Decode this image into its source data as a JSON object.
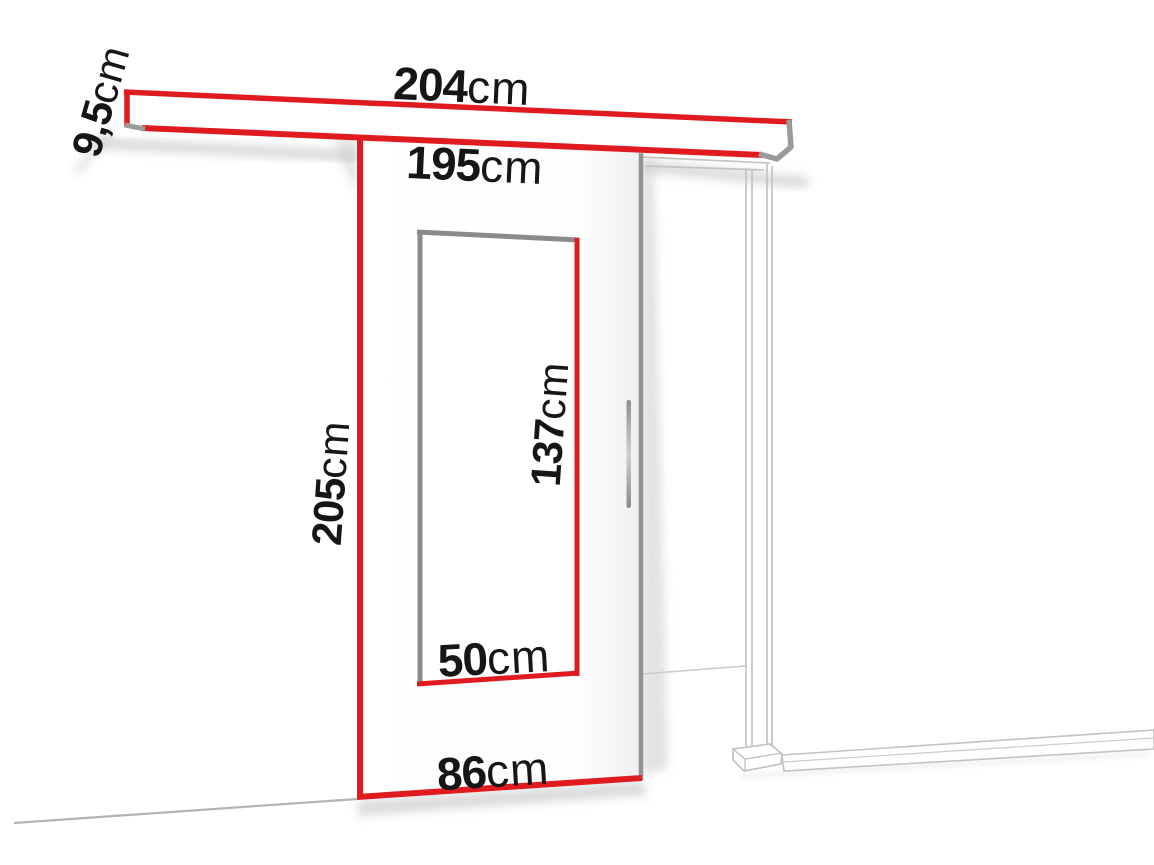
{
  "colors": {
    "accent": "#e01b20",
    "edge_gray": "#8f8f8f",
    "frame_gray": "#c3c3c3",
    "text": "#161616"
  },
  "diagram": {
    "type": "sliding-door-dimension-drawing"
  },
  "labels": {
    "track_length": {
      "value": "204",
      "unit": "cm"
    },
    "track_height": {
      "value": "9,5",
      "unit": "cm"
    },
    "opening_width": {
      "value": "195",
      "unit": "cm"
    },
    "door_height": {
      "value": "205",
      "unit": "cm"
    },
    "glass_height": {
      "value": "137",
      "unit": "cm"
    },
    "glass_width": {
      "value": "50",
      "unit": "cm"
    },
    "door_width": {
      "value": "86",
      "unit": "cm"
    }
  }
}
